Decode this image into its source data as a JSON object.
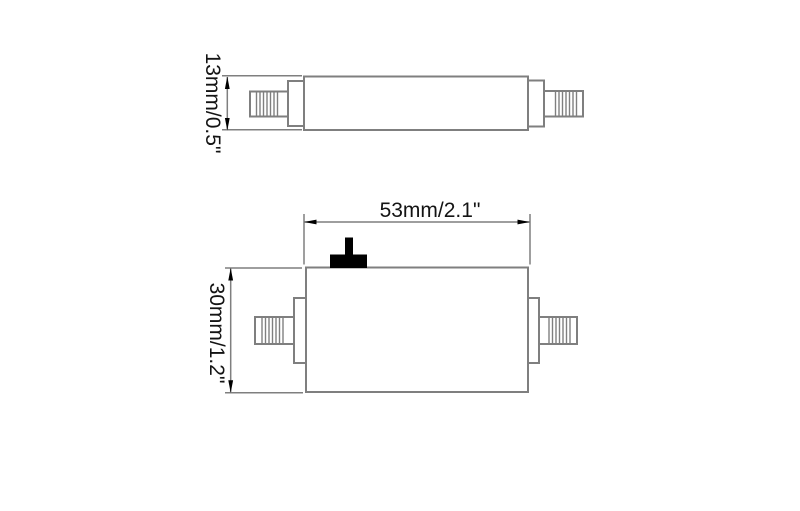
{
  "figure": {
    "kind": "dimensioned technical drawing, two views of a device with threaded coaxial connectors and a toggle switch",
    "views": {
      "side": {
        "height_label": "13mm/0.5\""
      },
      "front": {
        "width_label": "53mm/2.1\"",
        "height_label": "30mm/1.2\""
      }
    },
    "colors": {
      "outline": "#7f7f7f",
      "dimension": "#7f7f7f",
      "arrow": "#000000",
      "switch": "#000000",
      "text": "#141414",
      "background": "#ffffff"
    }
  }
}
